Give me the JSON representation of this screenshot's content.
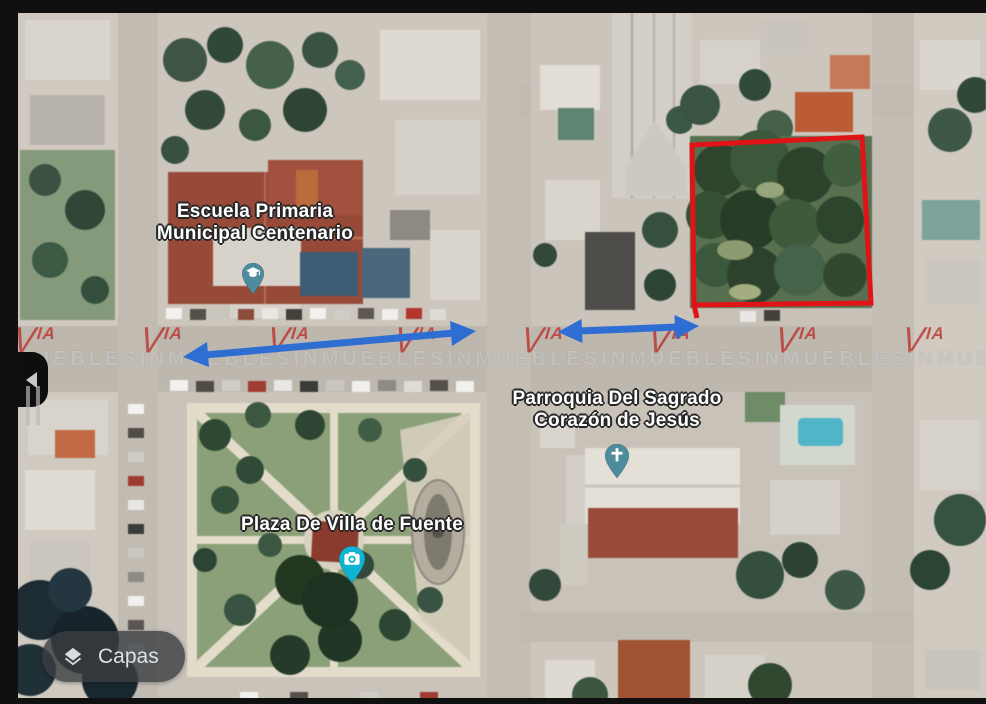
{
  "map": {
    "view_type": "satellite",
    "labels": [
      {
        "id": "school",
        "line1": "Escuela Primaria",
        "line2": "Municipal Centenario",
        "icon": "graduation-cap",
        "pin_color": "#4e8c9d"
      },
      {
        "id": "church",
        "line1": "Parroquia Del Sagrado",
        "line2": "Corazón de Jesús",
        "icon": "christian-cross",
        "pin_color": "#4e8c9d"
      },
      {
        "id": "plaza",
        "line1": "Plaza De Villa de Fuente",
        "line2": "",
        "icon": "camera",
        "pin_color": "#10b4d3"
      }
    ]
  },
  "controls": {
    "layers_button": {
      "label": "Capas",
      "icon": "layers"
    },
    "prev_arrow": {
      "icon": "chevron-left"
    }
  },
  "watermark": {
    "brand_v": "V",
    "brand_ia": "IA",
    "band_text": "INMUEBLESINMUEBLESINMUEBLESINMUEBLESINMUEBLESINMUEBLESINMUEBLESINMUEBLESINMUEBLES",
    "brand_color": "rgba(186,48,44,0.78)",
    "text_color": "rgba(228,228,228,0.52)"
  },
  "annotations": {
    "highlight_box": {
      "shape": "rectangle",
      "color": "#e01317"
    },
    "arrow_color": "#2e6ed3"
  }
}
